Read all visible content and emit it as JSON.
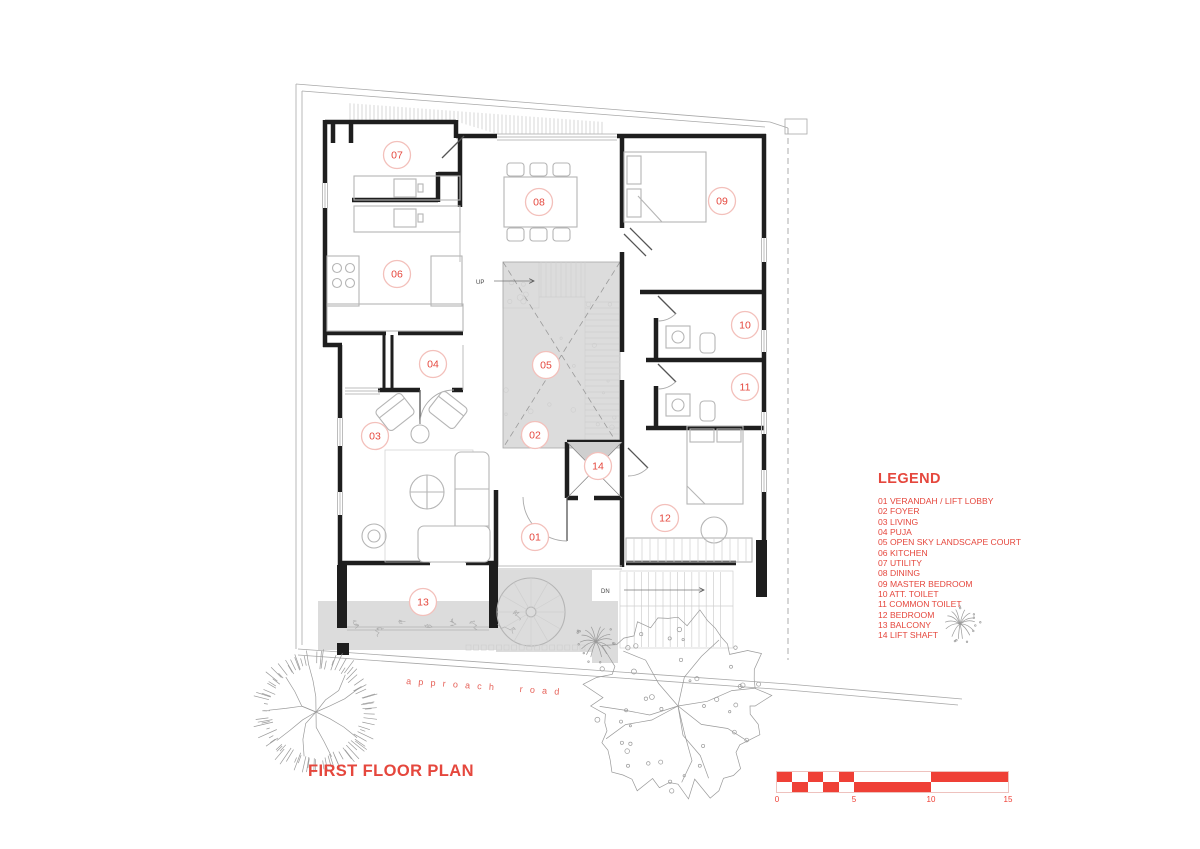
{
  "title": "FIRST FLOOR PLAN",
  "legend": {
    "title": "LEGEND",
    "items": [
      "01 VERANDAH / LIFT LOBBY",
      "02 FOYER",
      "03 LIVING",
      "04 PUJA",
      "05 OPEN SKY LANDSCAPE COURT",
      "06 KITCHEN",
      "07 UTILITY",
      "08 DINING",
      "09 MASTER BEDROOM",
      "10 ATT. TOILET",
      "11 COMMON TOILET",
      "12 BEDROOM",
      "13 BALCONY",
      "14 LIFT SHAFT"
    ]
  },
  "plan": {
    "rooms": [
      {
        "num": "07"
      },
      {
        "num": "08"
      },
      {
        "num": "09"
      },
      {
        "num": "06"
      },
      {
        "num": "10"
      },
      {
        "num": "04"
      },
      {
        "num": "05"
      },
      {
        "num": "11"
      },
      {
        "num": "03"
      },
      {
        "num": "02"
      },
      {
        "num": "14"
      },
      {
        "num": "12"
      },
      {
        "num": "01"
      },
      {
        "num": "13"
      }
    ],
    "up_label": "UP",
    "dn_label": "DN",
    "road_label": "approach road"
  },
  "scale_bar": {
    "labels": [
      "0",
      "5",
      "10",
      "15"
    ]
  },
  "colors": {
    "accent": "#e5473d",
    "scale_red": "#ef4036",
    "wall": "#1e1e1e",
    "furniture": "#b5b5b5",
    "shade": "#dcdcdc",
    "boundary": "#a8a8a8"
  }
}
